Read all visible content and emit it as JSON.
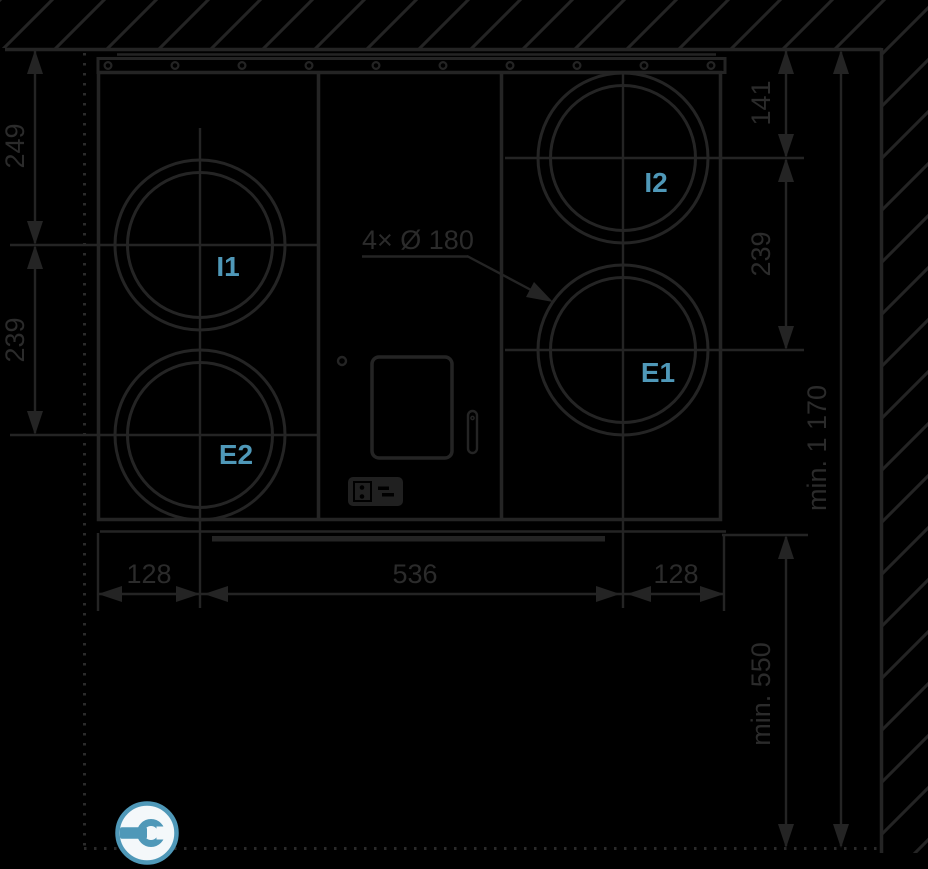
{
  "drawing": {
    "title": "ventilation-unit-installation-dimensions-front-view",
    "port_labels": {
      "i1": "I1",
      "i2": "I2",
      "e1": "E1",
      "e2": "E2"
    },
    "dimensions": {
      "left_top": "249",
      "left_bottom": "239",
      "right_top": "141",
      "right_middle": "239",
      "total_height_clearance": "min. 1 170",
      "bottom_clearance": "min. 550",
      "bottom_left": "128",
      "bottom_center": "536",
      "bottom_right": "128",
      "duct_ports": "4× Ø 180"
    },
    "colors": {
      "background": "#000000",
      "line": "#242424",
      "dim_text": "#2b2b2b",
      "accent": "#4f98b8",
      "icon_bg": "#f4f8fa"
    },
    "icons": {
      "service": "wrench-icon",
      "electrical": "electrical-connection-icon"
    }
  }
}
